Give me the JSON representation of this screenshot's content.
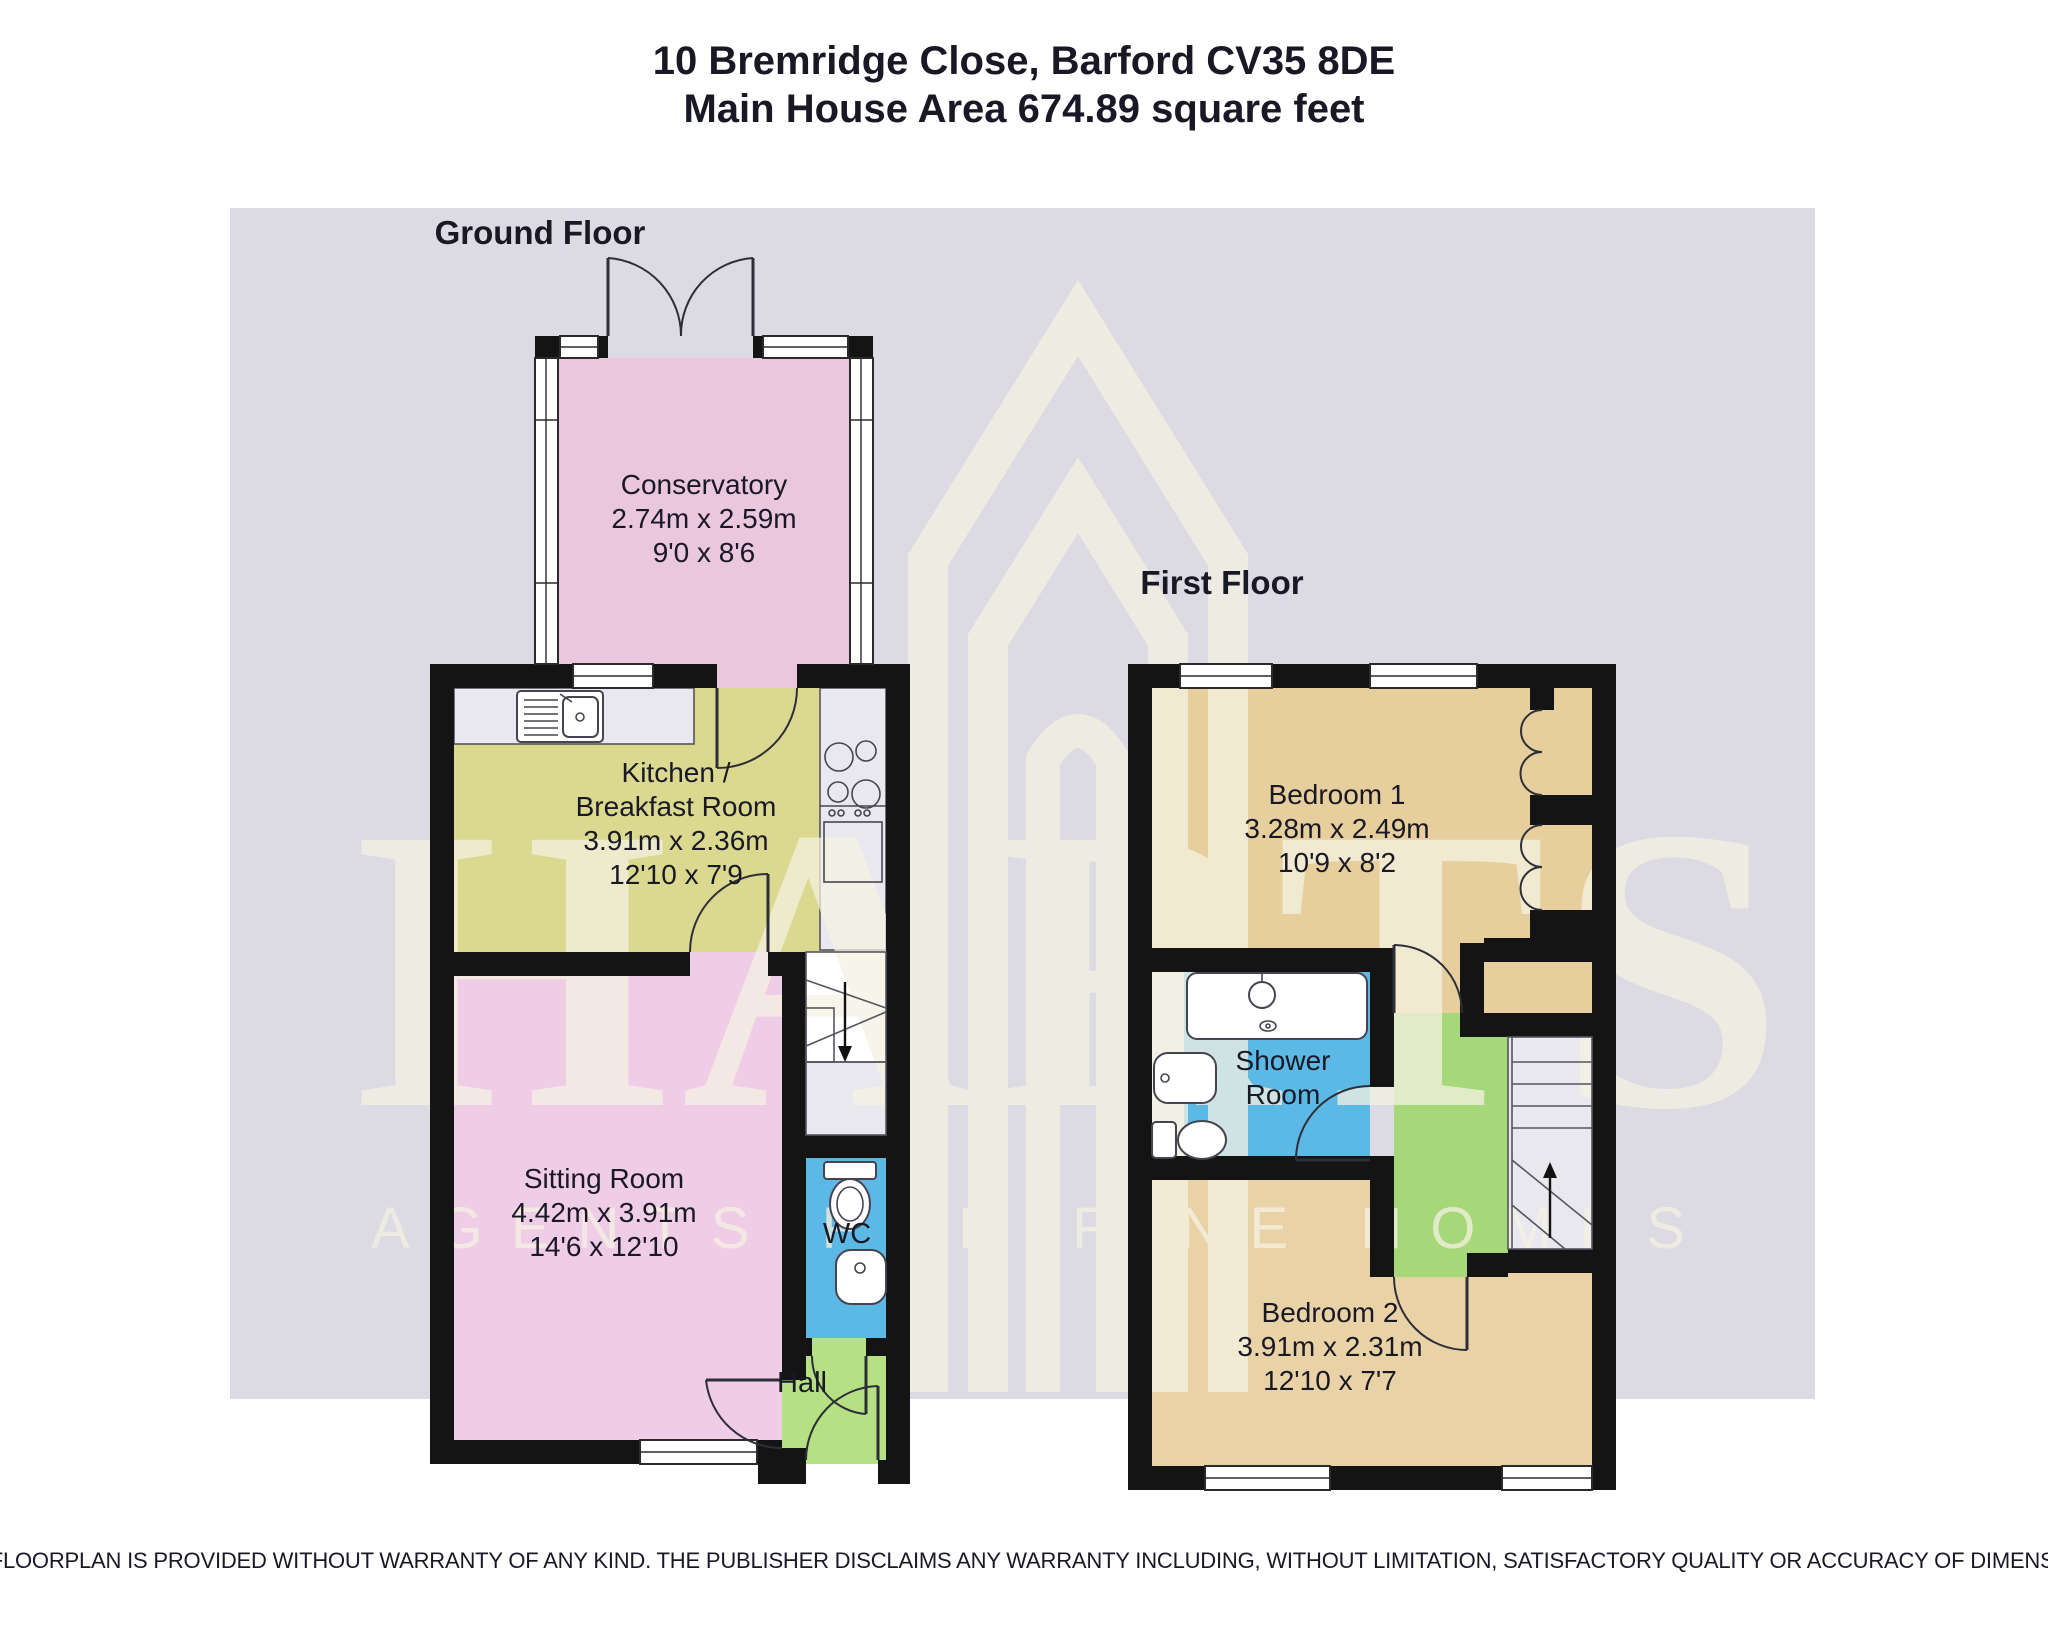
{
  "header": {
    "address": "10 Bremridge Close, Barford CV35 8DE",
    "area": "Main House Area 674.89 square feet"
  },
  "floors": {
    "ground": {
      "label": "Ground Floor"
    },
    "first": {
      "label": "First Floor"
    }
  },
  "rooms": {
    "conservatory": {
      "name": "Conservatory",
      "metric": "2.74m x 2.59m",
      "imperial": "9'0 x 8'6"
    },
    "kitchen": {
      "name": "Kitchen /",
      "name2": "Breakfast Room",
      "metric": "3.91m x 2.36m",
      "imperial": "12'10 x 7'9"
    },
    "sitting": {
      "name": "Sitting Room",
      "metric": "4.42m x 3.91m",
      "imperial": "14'6 x 12'10"
    },
    "wc": {
      "name": "WC"
    },
    "hall": {
      "name": "Hall"
    },
    "bedroom1": {
      "name": "Bedroom 1",
      "metric": "3.28m x 2.49m",
      "imperial": "10'9 x 8'2"
    },
    "shower": {
      "name": "Shower",
      "name2": "Room"
    },
    "bedroom2": {
      "name": "Bedroom 2",
      "metric": "3.91m x 2.31m",
      "imperial": "12'10 x 7'7"
    }
  },
  "watermark": {
    "brand": "HARTS",
    "tagline": "AGENTS FOR FINE HOMES"
  },
  "disclaimer": "THIS FLOORPLAN IS PROVIDED WITHOUT WARRANTY OF ANY KIND. THE PUBLISHER DISCLAIMS ANY WARRANTY INCLUDING, WITHOUT LIMITATION, SATISFACTORY QUALITY OR ACCURACY OF DIMENSIONS.",
  "colors": {
    "lavender": "#dcdae3",
    "pink": "#eac6df",
    "sittingPink": "#f0cde6",
    "yellow": "#dbd88f",
    "tan": "#e7cf9d",
    "tan2": "#e9d3a6",
    "blue": "#5cb8e4",
    "hallGreen": "#b6e084",
    "landingGreen": "#a6d87a",
    "wall": "#141414",
    "counter": "#e9e8ef",
    "cream": "#f5f2e2",
    "vanity": "#eceaf1"
  }
}
